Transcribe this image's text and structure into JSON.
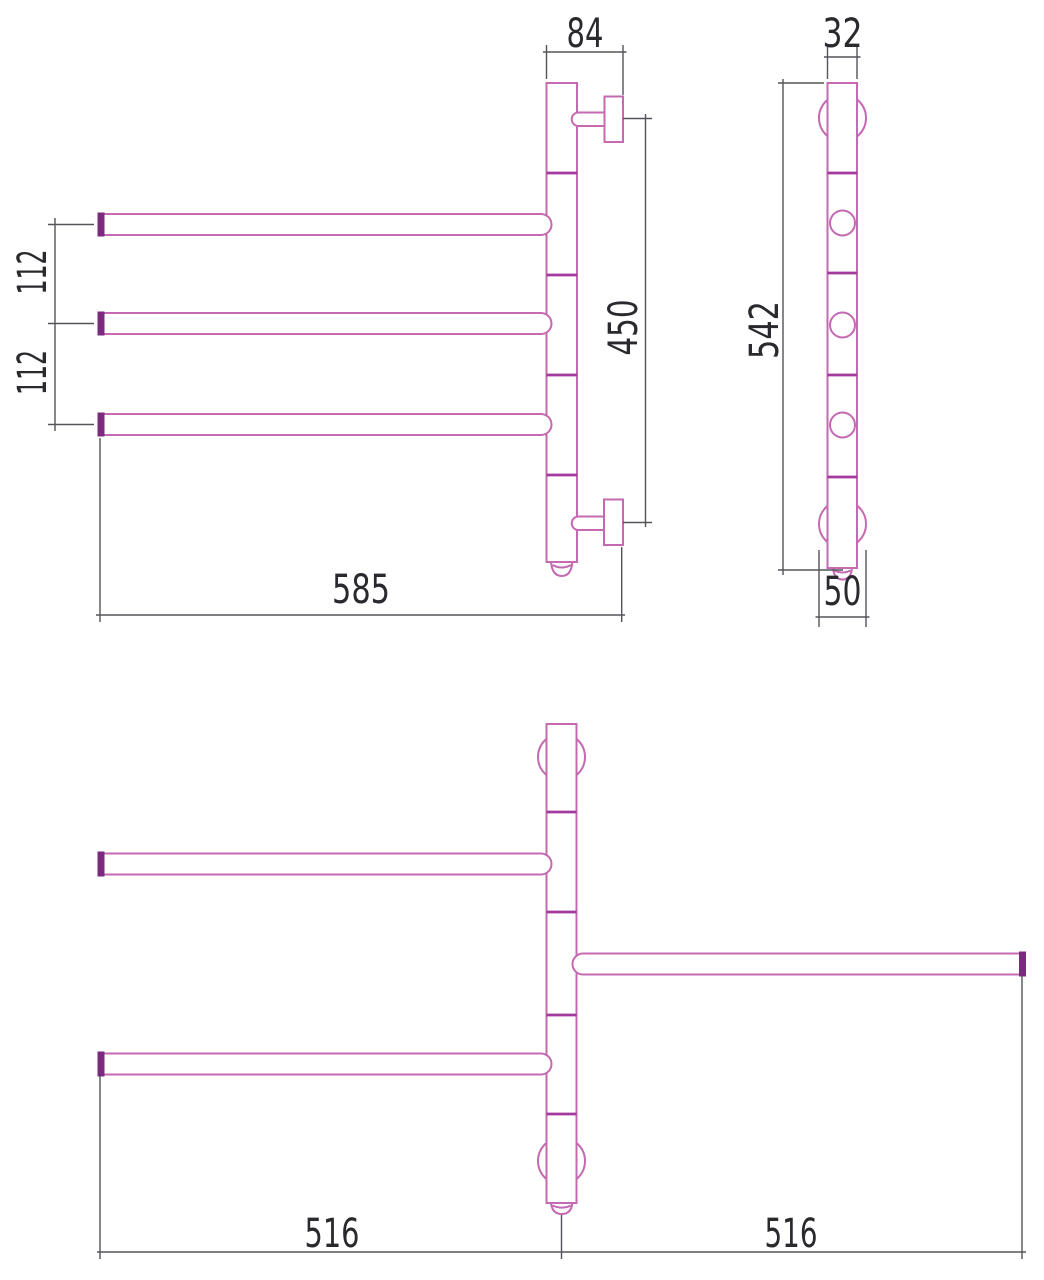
{
  "drawing": {
    "kind": "technical-dimension-drawing",
    "subject": "wall-mounted swivel towel rail, three views",
    "colors": {
      "outline": "#c469b2",
      "joint_line": "#a23a9e",
      "end_cap": "#7c2a80",
      "dimension_line": "#53535a",
      "text": "#2a2a2e",
      "background": "#ffffff"
    },
    "views": {
      "front": {
        "label": "front elevation",
        "dims": {
          "bracket_offset_top": "84",
          "arm_gap_upper": "112",
          "arm_gap_lower": "112",
          "bracket_span": "450",
          "overall_width": "585"
        }
      },
      "side": {
        "label": "side profile",
        "dims": {
          "tube_width": "32",
          "overall_height": "542",
          "bracket_diameter": "50"
        }
      },
      "plan": {
        "label": "top plan with swivelled arm",
        "dims": {
          "arm_reach_left": "516",
          "arm_reach_right": "516"
        }
      }
    }
  }
}
